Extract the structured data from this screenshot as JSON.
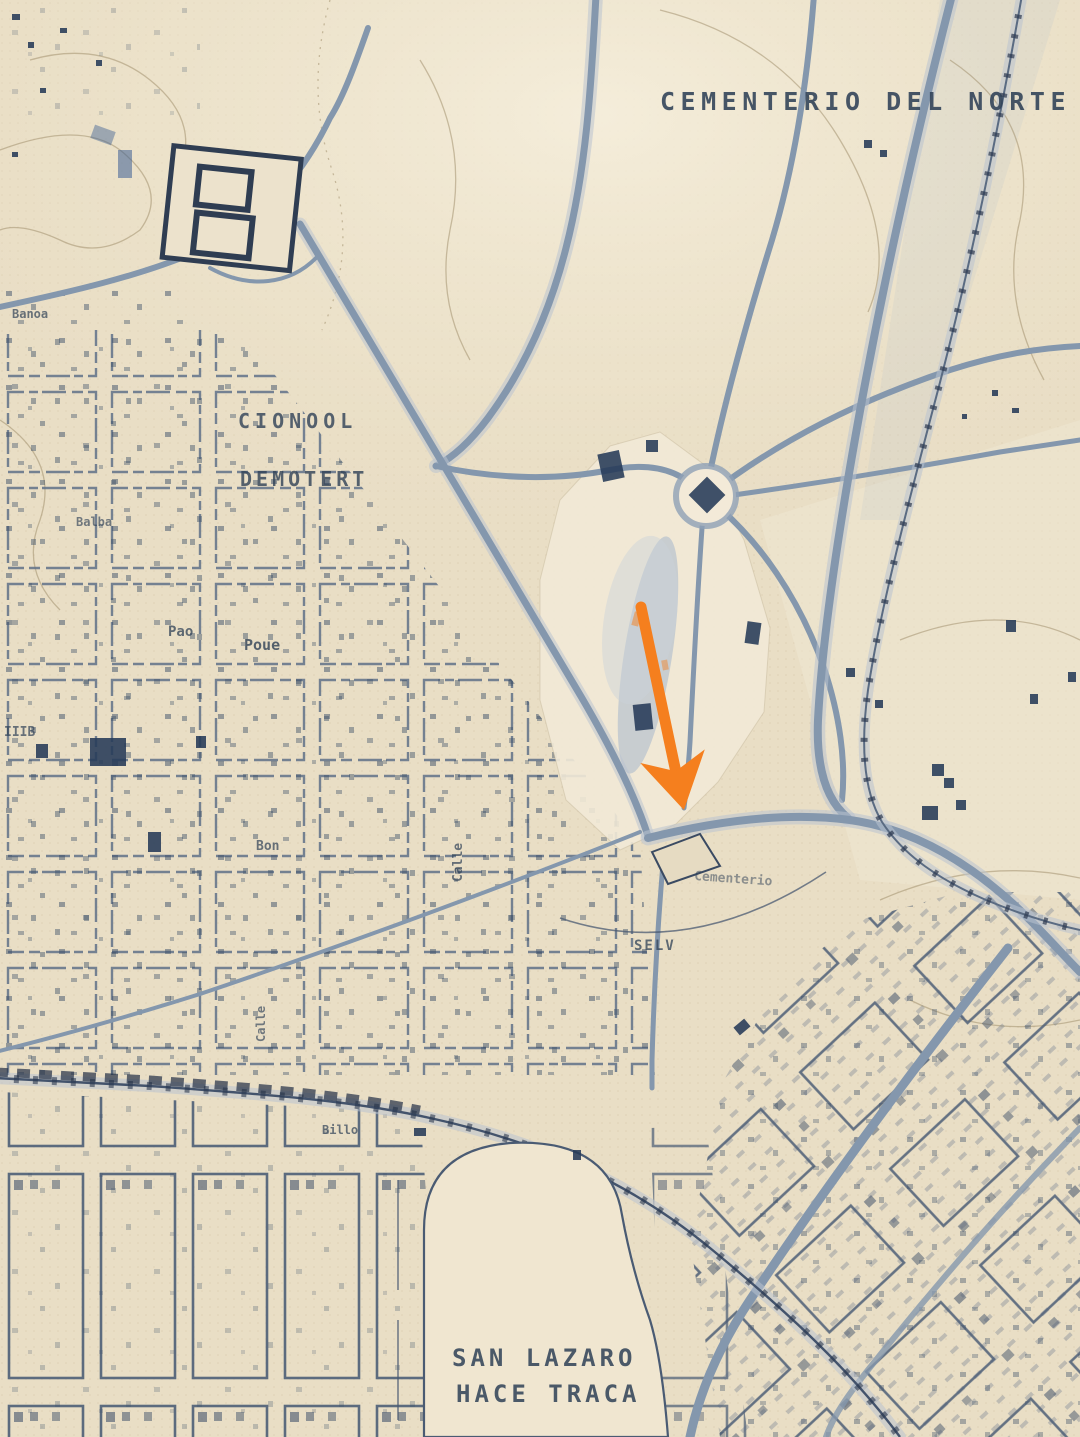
{
  "map": {
    "name": "vintage-city-map",
    "district_top_label": "CEMENTERIO DEL NORTE",
    "district_bottom_label_line1": "SAN LAZARO",
    "district_bottom_label_line2": "HACE TRACA"
  },
  "palette": {
    "paper": "#e9dec5",
    "paper_light": "#f3ecda",
    "ink": "#2f4157",
    "road": "#8497ad",
    "navy": "#263a58",
    "shade": "#b6c2cd",
    "arrow_orange": "#f57f1e"
  },
  "annotation": {
    "arrow": {
      "x1": 641,
      "y1": 607,
      "x2": 678,
      "y2": 782,
      "width": 11,
      "color": "#f57f1e"
    }
  },
  "labels": [
    {
      "t": "CEMENTERIO DEL NORTE",
      "x": 660,
      "y": 110,
      "s": 25,
      "ls": 5.5,
      "o": 0.88
    },
    {
      "t": "CIONOOL",
      "x": 238,
      "y": 428,
      "s": 20,
      "ls": 5,
      "o": 0.8
    },
    {
      "t": "DEMOTERT",
      "x": 240,
      "y": 486,
      "s": 20,
      "ls": 4,
      "o": 0.8
    },
    {
      "t": "SAN LAZARO",
      "x": 452,
      "y": 1366,
      "s": 24,
      "ls": 4,
      "o": 0.85
    },
    {
      "t": "HACE TRACA",
      "x": 456,
      "y": 1402,
      "s": 24,
      "ls": 4,
      "o": 0.85
    },
    {
      "t": "Banoa",
      "x": 12,
      "y": 318,
      "s": 12,
      "o": 0.7
    },
    {
      "t": "Balba",
      "x": 76,
      "y": 526,
      "s": 12,
      "o": 0.65
    },
    {
      "t": "Pao",
      "x": 168,
      "y": 636,
      "s": 14,
      "o": 0.75
    },
    {
      "t": "Poue",
      "x": 244,
      "y": 650,
      "s": 15,
      "o": 0.8
    },
    {
      "t": "IIIB",
      "x": 4,
      "y": 736,
      "s": 13,
      "o": 0.7
    },
    {
      "t": "Bon",
      "x": 256,
      "y": 850,
      "s": 13,
      "o": 0.7
    },
    {
      "t": "Billo",
      "x": 322,
      "y": 1134,
      "s": 12,
      "o": 0.7
    },
    {
      "t": "Calle",
      "x": 462,
      "y": 882,
      "s": 13,
      "r": -90,
      "o": 0.7
    },
    {
      "t": "Calle",
      "x": 265,
      "y": 1042,
      "s": 12,
      "r": -90,
      "o": 0.65
    },
    {
      "t": "SELV",
      "x": 634,
      "y": 950,
      "s": 14,
      "ls": 2,
      "o": 0.75
    },
    {
      "t": "Cementerio",
      "x": 694,
      "y": 880,
      "s": 13,
      "r": 4,
      "o": 0.5
    }
  ],
  "marks": [
    {
      "x": 600,
      "y": 452,
      "w": 22,
      "h": 28,
      "r": -12
    },
    {
      "x": 646,
      "y": 440,
      "w": 12,
      "h": 12,
      "r": 0
    },
    {
      "x": 694,
      "y": 482,
      "w": 26,
      "h": 26,
      "r": 45
    },
    {
      "x": 746,
      "y": 622,
      "w": 14,
      "h": 22,
      "r": 8
    },
    {
      "x": 634,
      "y": 704,
      "w": 18,
      "h": 26,
      "r": -6
    },
    {
      "x": 90,
      "y": 738,
      "w": 36,
      "h": 28,
      "r": 0
    },
    {
      "x": 148,
      "y": 832,
      "w": 13,
      "h": 20,
      "r": 0
    },
    {
      "x": 36,
      "y": 744,
      "w": 12,
      "h": 14,
      "r": 0
    },
    {
      "x": 196,
      "y": 736,
      "w": 10,
      "h": 12,
      "r": 0
    },
    {
      "x": 1006,
      "y": 620,
      "w": 10,
      "h": 12,
      "r": 0
    },
    {
      "x": 932,
      "y": 764,
      "w": 12,
      "h": 12,
      "r": 0
    },
    {
      "x": 944,
      "y": 778,
      "w": 10,
      "h": 10,
      "r": 0
    },
    {
      "x": 922,
      "y": 806,
      "w": 16,
      "h": 14,
      "r": 0
    },
    {
      "x": 956,
      "y": 800,
      "w": 10,
      "h": 10,
      "r": 0
    },
    {
      "x": 1030,
      "y": 694,
      "w": 8,
      "h": 10,
      "r": 0
    },
    {
      "x": 1068,
      "y": 672,
      "w": 8,
      "h": 10,
      "r": 0
    },
    {
      "x": 846,
      "y": 668,
      "w": 9,
      "h": 9,
      "r": 0
    },
    {
      "x": 875,
      "y": 700,
      "w": 8,
      "h": 8,
      "r": 0
    },
    {
      "x": 864,
      "y": 140,
      "w": 8,
      "h": 8,
      "r": 0
    },
    {
      "x": 880,
      "y": 150,
      "w": 7,
      "h": 7,
      "r": 0
    },
    {
      "x": 992,
      "y": 390,
      "w": 6,
      "h": 6,
      "r": 0
    },
    {
      "x": 1012,
      "y": 408,
      "w": 7,
      "h": 5,
      "r": 0
    },
    {
      "x": 962,
      "y": 414,
      "w": 5,
      "h": 5,
      "r": 0
    },
    {
      "x": 735,
      "y": 1022,
      "w": 14,
      "h": 10,
      "r": -40
    },
    {
      "x": 658,
      "y": 772,
      "w": 24,
      "h": 8,
      "r": -25,
      "c": "dark"
    },
    {
      "x": 414,
      "y": 1128,
      "w": 12,
      "h": 8,
      "r": 0
    },
    {
      "x": 573,
      "y": 1150,
      "w": 8,
      "h": 10,
      "r": 0
    },
    {
      "x": 12,
      "y": 14,
      "w": 8,
      "h": 6,
      "r": 0
    },
    {
      "x": 28,
      "y": 42,
      "w": 6,
      "h": 6,
      "r": 0
    },
    {
      "x": 60,
      "y": 28,
      "w": 7,
      "h": 5,
      "r": 0
    },
    {
      "x": 96,
      "y": 60,
      "w": 6,
      "h": 6,
      "r": 0
    },
    {
      "x": 40,
      "y": 88,
      "w": 6,
      "h": 5,
      "r": 0
    },
    {
      "x": 12,
      "y": 152,
      "w": 6,
      "h": 5,
      "r": 0
    },
    {
      "x": 118,
      "y": 150,
      "w": 14,
      "h": 28,
      "r": 0,
      "c": "blue",
      "o": 0.55
    },
    {
      "x": 92,
      "y": 128,
      "w": 22,
      "h": 14,
      "r": 20,
      "c": "blue",
      "o": 0.45
    },
    {
      "x": 633,
      "y": 612,
      "w": 7,
      "h": 14,
      "r": 15,
      "c": "accent",
      "o": 0.5
    },
    {
      "x": 662,
      "y": 660,
      "w": 6,
      "h": 10,
      "r": -10,
      "c": "accent",
      "o": 0.45
    }
  ]
}
